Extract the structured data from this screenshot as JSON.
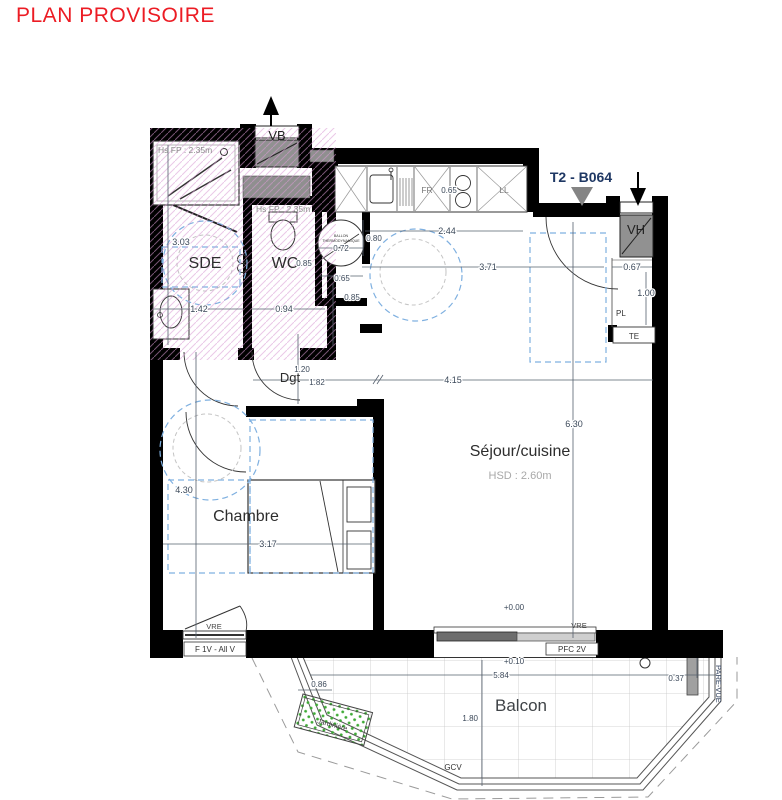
{
  "title": "PLAN PROVISOIRE",
  "unit_label": "T2 - B064",
  "rooms": {
    "sde": {
      "label": "SDE",
      "ceiling_note": "Hs FP : 2.35m"
    },
    "wc": {
      "label": "WC",
      "ceiling_note": "Hs FP : 2.35m"
    },
    "dgt": {
      "label": "Dgt"
    },
    "sejour": {
      "label": "Séjour/cuisine",
      "ceiling_note": "HSD : 2.60m"
    },
    "chambre": {
      "label": "Chambre"
    },
    "balcon": {
      "label": "Balcon"
    }
  },
  "equipment": {
    "vb": "VB",
    "vh": "VH",
    "fr": "FR",
    "ll": "LL",
    "pl": "PL",
    "te": "TE",
    "ballon_line1": "BALLON",
    "ballon_line2": "THERMODYNAMIQUE",
    "vre_chambre": "VRE",
    "vre_sejour": "VRE",
    "window_chambre": "F 1V - All V",
    "window_sejour": "PFC 2V",
    "gcv": "GCV",
    "pare_vue": "PARE-VUE",
    "jardiniere": "Jardinière"
  },
  "levels": {
    "interior": "+0.00",
    "balcony": "+0.10"
  },
  "dimensions": {
    "sde_depth": "3.03",
    "sde_width": "1.42",
    "wc_width": "0.94",
    "wc_depth": "0.85",
    "ballon_width": "0.72",
    "ballon_front": "0.80",
    "ballon_clear_w": "0.65",
    "ballon_clear_d": "0.85",
    "kitchen_width": "2.44",
    "kitchen_fr": "0.65",
    "entry_width": "3.71",
    "pl_width": "0.67",
    "pl_depth": "1.00",
    "dgt_width": "1.20",
    "dgt_length": "1.82",
    "sejour_width": "4.15",
    "sejour_depth": "6.30",
    "chambre_depth": "4.30",
    "chambre_width": "3.17",
    "balcon_width": "5.84",
    "balcon_depth": "1.80",
    "balcon_side": "0.86",
    "pare_vue_width": "0.37"
  },
  "colors": {
    "title_red": "#ec1c24",
    "unit_navy": "#1f3864",
    "accessibility_blue": "#7fb0e0",
    "hatch_pink": "#d99bd4",
    "jardiniere_green": "#3daa35",
    "wall_black": "#000000",
    "fixture_gray": "#8f8f8f"
  }
}
